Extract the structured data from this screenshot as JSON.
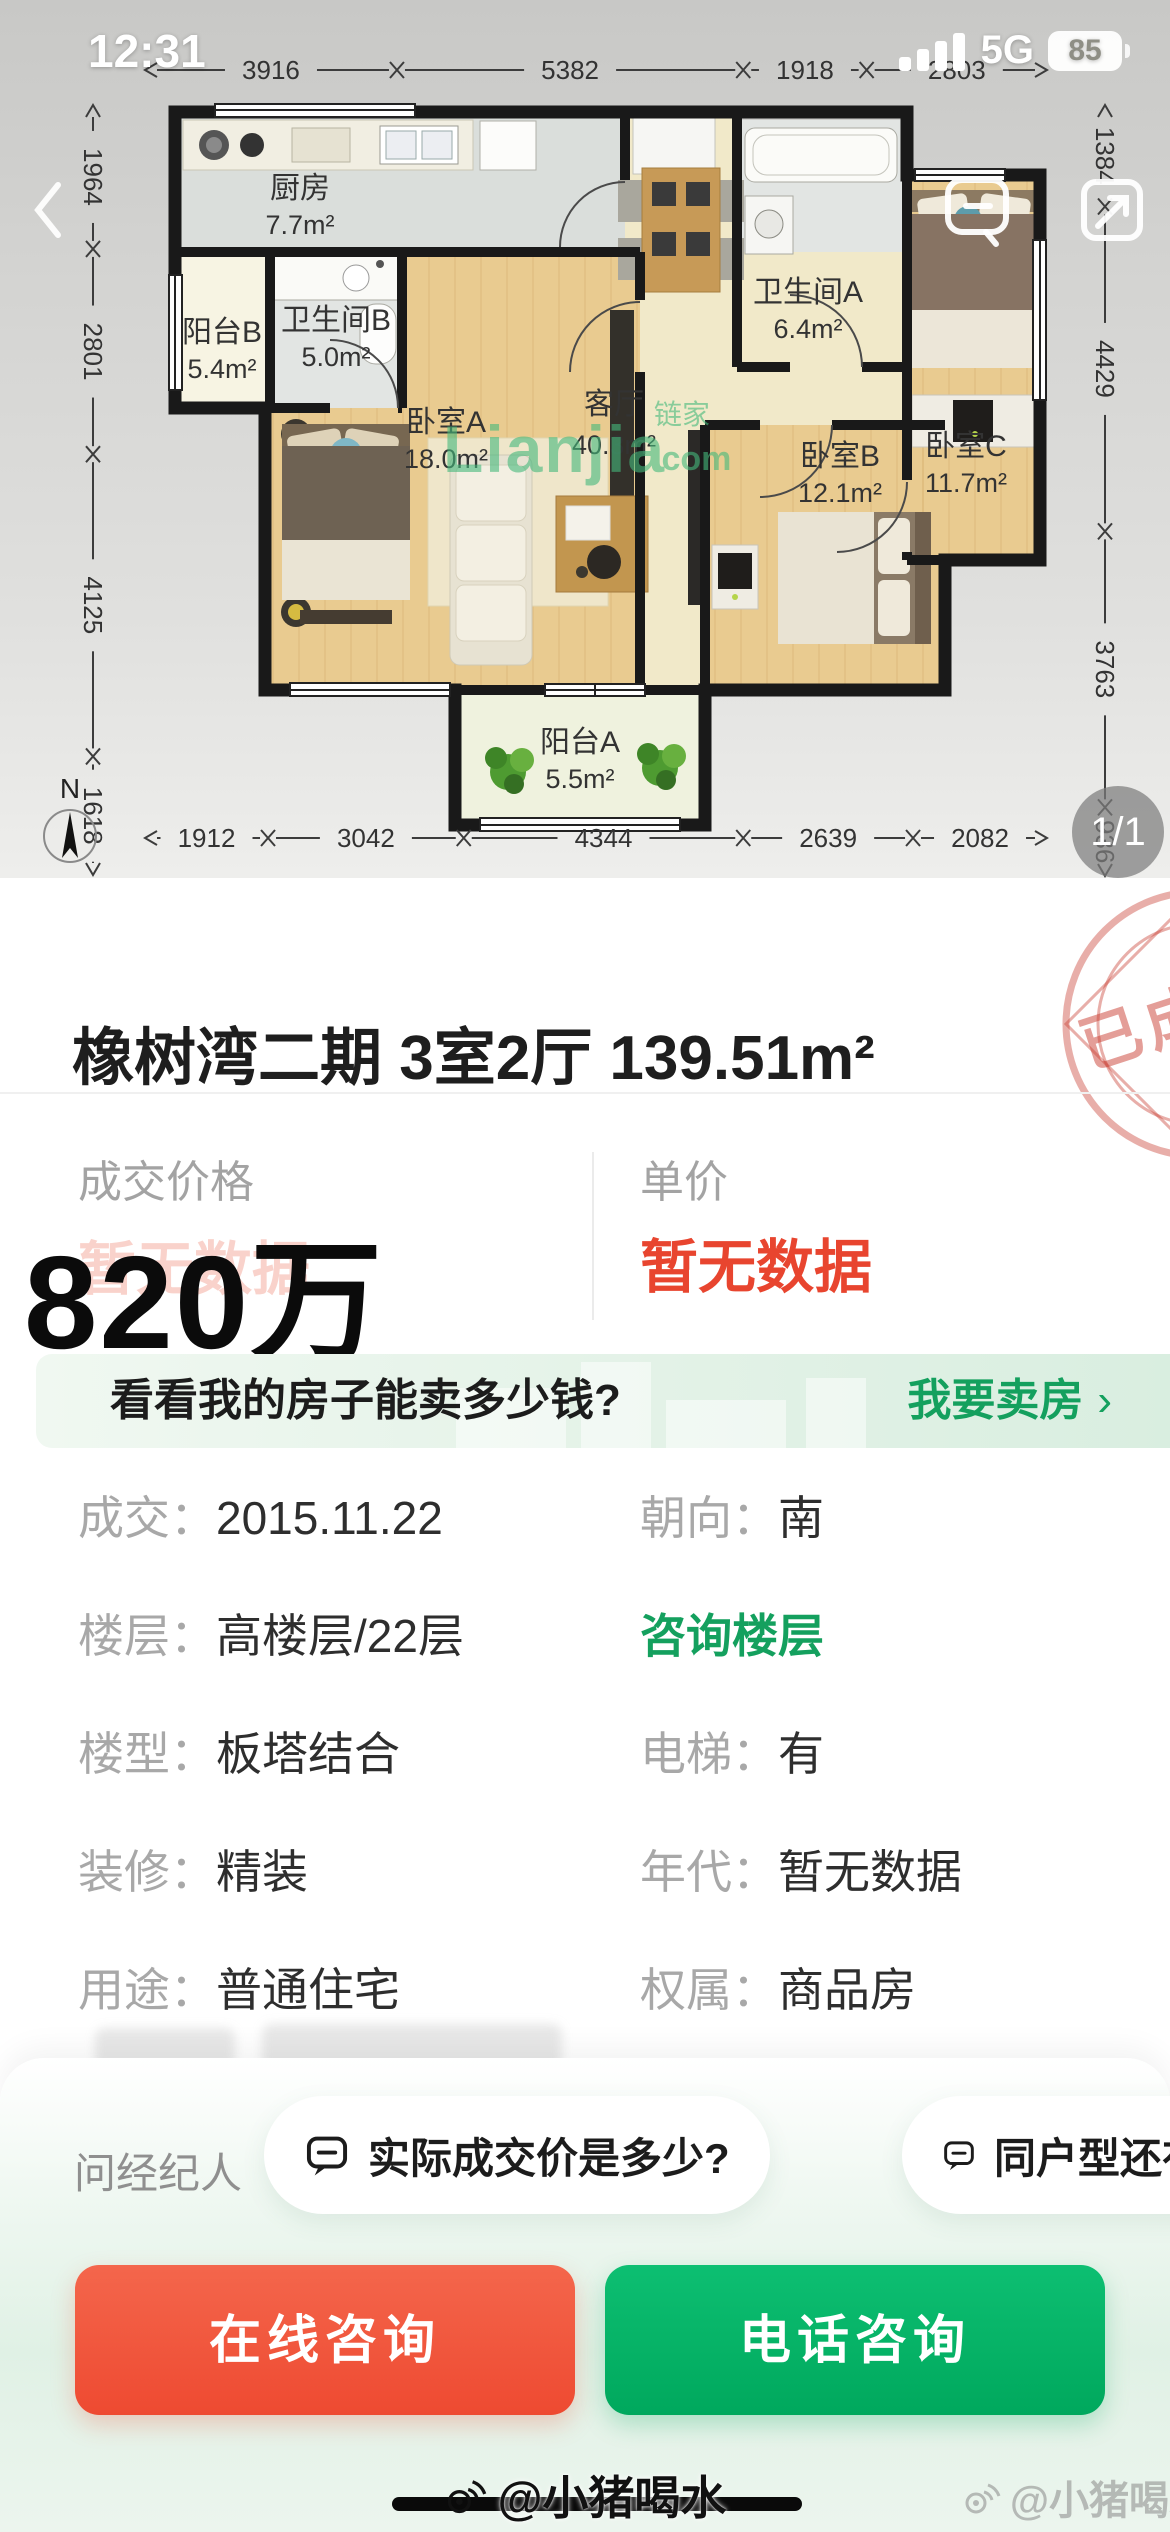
{
  "status_bar": {
    "time": "12:31",
    "network": "5G",
    "battery": "85"
  },
  "floor_plan": {
    "dims": {
      "top": [
        "3916",
        "5382",
        "1918",
        "2803"
      ],
      "left": [
        "1964",
        "2801",
        "4125",
        "1618"
      ],
      "right": [
        "1384",
        "4429",
        "3763",
        "936"
      ],
      "bottom": [
        "1912",
        "3042",
        "4344",
        "2639",
        "2082"
      ]
    },
    "rooms": {
      "kitchen": {
        "name": "厨房",
        "area": "7.7m²"
      },
      "balcony_b": {
        "name": "阳台B",
        "area": "5.4m²"
      },
      "bath_b": {
        "name": "卫生间B",
        "area": "5.0m²"
      },
      "bed_a": {
        "name": "卧室A",
        "area": "18.0m²"
      },
      "living": {
        "name": "客厅",
        "area": "40.3m²"
      },
      "bath_a": {
        "name": "卫生间A",
        "area": "6.4m²"
      },
      "bed_c": {
        "name": "卧室C",
        "area": "11.7m²"
      },
      "bed_b": {
        "name": "卧室B",
        "area": "12.1m²"
      },
      "balcony_a": {
        "name": "阳台A",
        "area": "5.5m²"
      }
    },
    "watermark": {
      "brand": "Lianjia",
      "cjk": "链家",
      "suffix": ".com"
    },
    "compass": "N",
    "page_indicator": "1/1"
  },
  "title": {
    "text": "橡树湾二期 3室2厅 139.51m²",
    "stamp": "已成交"
  },
  "price": {
    "deal_label": "成交价格",
    "deal_value": "暂无数据",
    "overlay": "820万",
    "unit_label": "单价",
    "unit_value": "暂无数据"
  },
  "banner": {
    "question": "看看我的房子能卖多少钱?",
    "action": "我要卖房",
    "chevron": "›"
  },
  "details": {
    "rows": [
      {
        "l1": "成交：",
        "v1": "2015.11.22",
        "l2": "朝向：",
        "v2": "南",
        "link2": ""
      },
      {
        "l1": "楼层：",
        "v1": "高楼层/22层",
        "l2": "",
        "v2": "",
        "link2": "咨询楼层"
      },
      {
        "l1": "楼型：",
        "v1": "板塔结合",
        "l2": "电梯：",
        "v2": "有",
        "link2": ""
      },
      {
        "l1": "装修：",
        "v1": "精装",
        "l2": "年代：",
        "v2": "暂无数据",
        "link2": ""
      },
      {
        "l1": "用途：",
        "v1": "普通住宅",
        "l2": "权属：",
        "v2": "商品房",
        "link2": ""
      }
    ]
  },
  "ask": {
    "label": "问经纪人",
    "chip1": "实际成交价是多少?",
    "chip2": "同户型还有其他房源"
  },
  "cta": {
    "online": "在线咨询",
    "phone": "电话咨询"
  },
  "watermarks": {
    "center": "@小猪喝水",
    "corner": "@小猪喝水"
  }
}
